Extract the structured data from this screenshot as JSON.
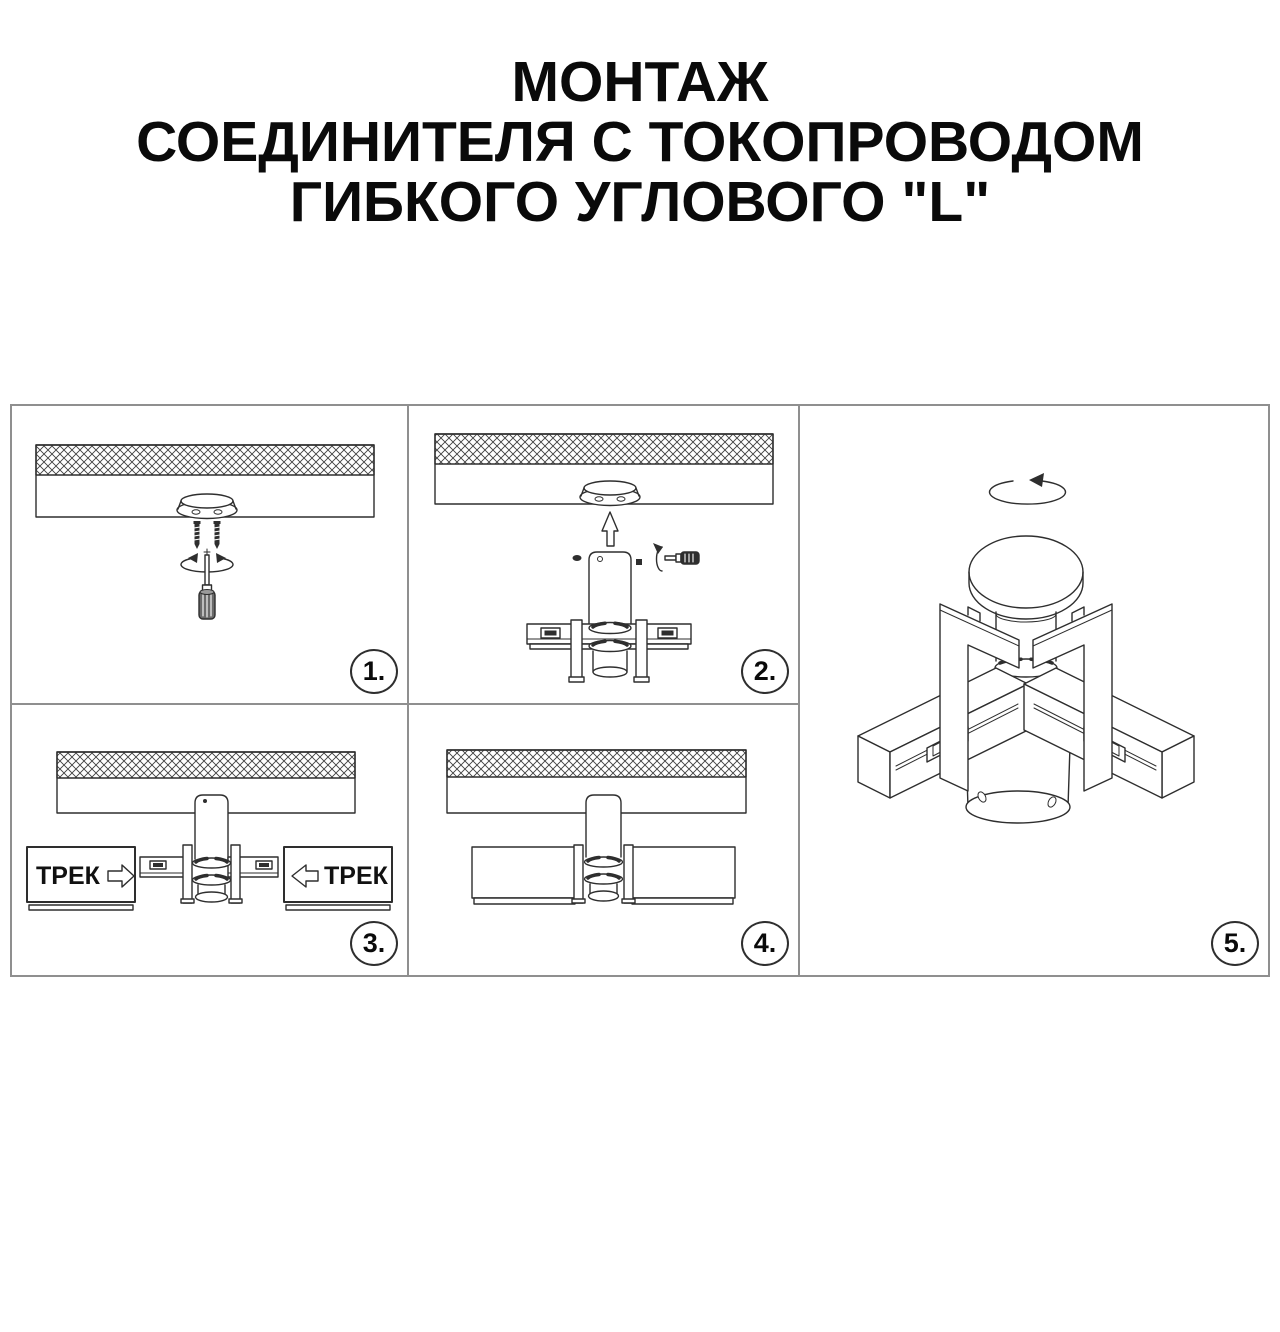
{
  "title": {
    "line1": "МОНТАЖ",
    "line2": "СОЕДИНИТЕЛЯ С ТОКОПРОВОДОМ",
    "line3": "ГИБКОГО УГЛОВОГО \"L\""
  },
  "colors": {
    "background": "#ffffff",
    "line_art": "#2e2e2e",
    "panel_border": "#8f8f8f",
    "title_text": "#0a0a0a"
  },
  "steps": {
    "step1": {
      "badge": "1.",
      "icons": [
        "ceiling-hatch",
        "mounting-plate",
        "screw",
        "screw",
        "rotation-arrow",
        "screwdriver-vertical"
      ]
    },
    "step2": {
      "badge": "2.",
      "icons": [
        "ceiling-hatch",
        "mounting-plate",
        "arrow-up",
        "connector-body",
        "set-screw",
        "rotation-arrow",
        "screwdriver-horizontal",
        "track-adapter"
      ]
    },
    "step3": {
      "badge": "3.",
      "track_label_left": "ТРЕК",
      "track_label_right": "ТРЕК",
      "icons": [
        "ceiling-hatch",
        "connector-body",
        "track-segment",
        "arrow-right",
        "arrow-left"
      ]
    },
    "step4": {
      "badge": "4.",
      "icons": [
        "ceiling-hatch",
        "connector-body",
        "tracks-joined"
      ]
    },
    "step5": {
      "badge": "5.",
      "icons": [
        "rotation-arrow",
        "connector-3d-view"
      ]
    }
  }
}
